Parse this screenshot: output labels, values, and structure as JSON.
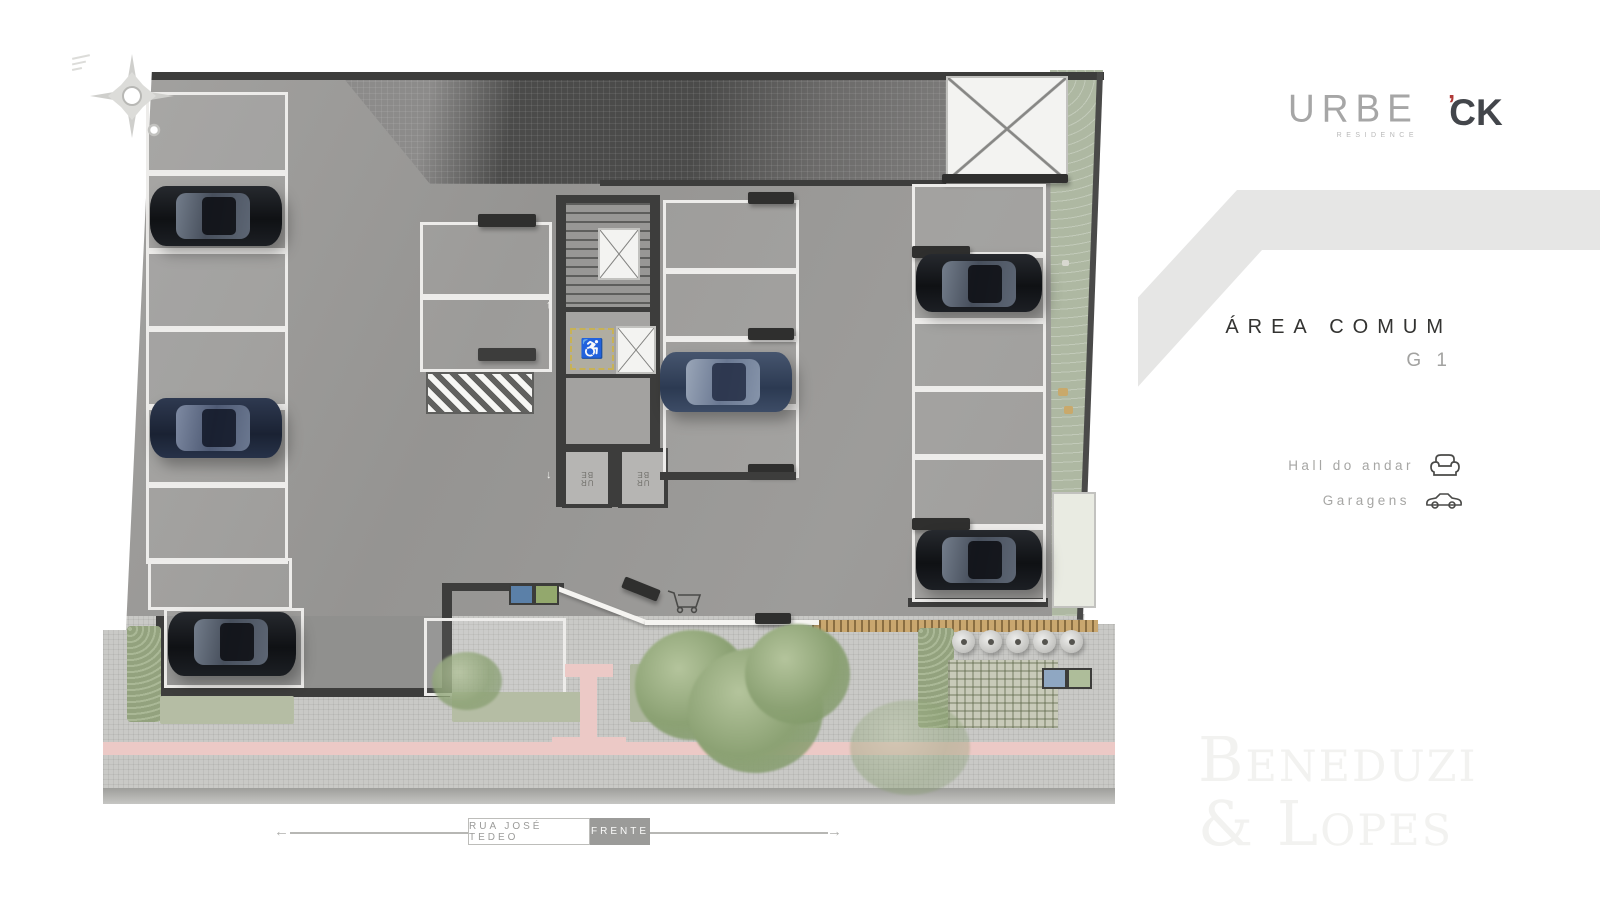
{
  "branding": {
    "urbe": {
      "name": "URBE",
      "subtitle": "RESIDENCE"
    },
    "ck": {
      "text": "CK",
      "tick": "’",
      "accent_color": "#b03a37"
    },
    "watermark": {
      "line1": "Beneduzi",
      "line2": "& Lopes"
    }
  },
  "panel": {
    "title": "ÁREA COMUM",
    "subtitle": "G 1",
    "legend": [
      {
        "label": "Hall do andar",
        "icon": "sofa-icon"
      },
      {
        "label": "Garagens",
        "icon": "car-icon"
      }
    ]
  },
  "street": {
    "name_label": "RUA JOSÉ TEDEO",
    "front_label": "FRENTE",
    "arrow_left": "←",
    "arrow_right": "→"
  },
  "plan": {
    "elevators": {
      "line1": "UR",
      "line2": "BE"
    },
    "accessible_symbol": "♿",
    "arrow_up": "↑",
    "arrow_down": "↓",
    "colors": {
      "floor": "#9a9998",
      "walls": "#3d3d3c",
      "stall_lines": "#edecea",
      "green_strip": "#aeb8a2",
      "pink_path": "#ecc9c6",
      "dark_paving": "#4b4b4a"
    }
  }
}
